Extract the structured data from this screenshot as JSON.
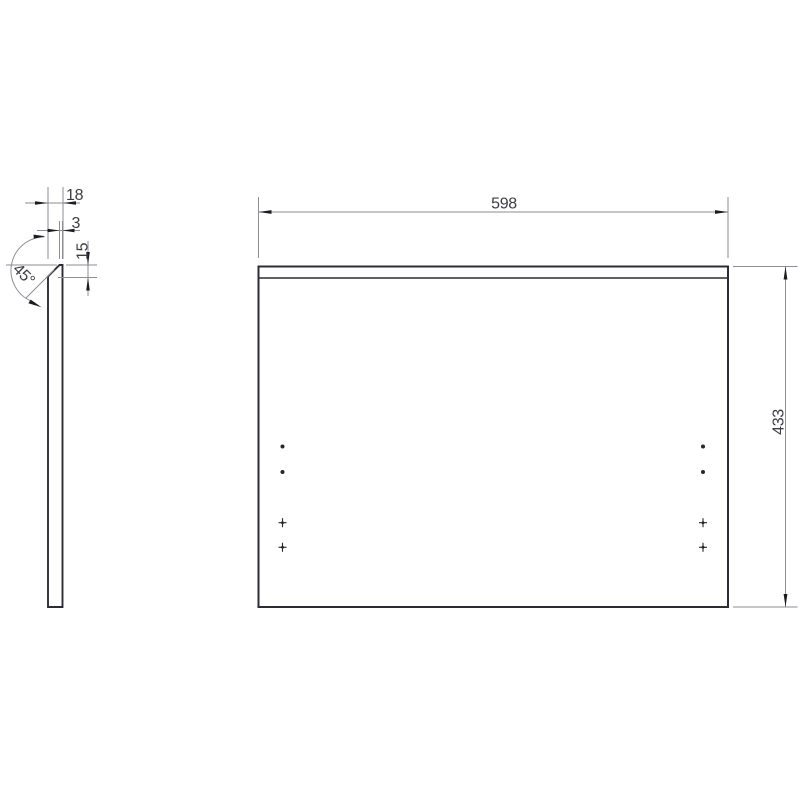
{
  "drawing": {
    "type": "technical-drawing",
    "subject": "panel with 45-degree chamfered top edge, two orthographic views",
    "colors": {
      "background": "#ffffff",
      "object_lines": "#2c2c34",
      "dimension_lines": "#8d8d95",
      "arrowheads": "#1b1b21",
      "text": "#3c3c46"
    },
    "side_view": {
      "name": "side profile view",
      "dims": {
        "thickness": "18",
        "top_flat": "3",
        "chamfer_height": "15",
        "chamfer_angle": "45°"
      }
    },
    "front_view": {
      "name": "front view",
      "dims": {
        "width": "598",
        "height": "433"
      },
      "hole_marks": {
        "round_holes": [
          {
            "column": "left",
            "row": 1
          },
          {
            "column": "left",
            "row": 2
          },
          {
            "column": "right",
            "row": 1
          },
          {
            "column": "right",
            "row": 2
          }
        ],
        "cross_center_marks": [
          {
            "column": "left",
            "row": 3
          },
          {
            "column": "left",
            "row": 4
          },
          {
            "column": "right",
            "row": 3
          },
          {
            "column": "right",
            "row": 4
          }
        ]
      }
    }
  }
}
